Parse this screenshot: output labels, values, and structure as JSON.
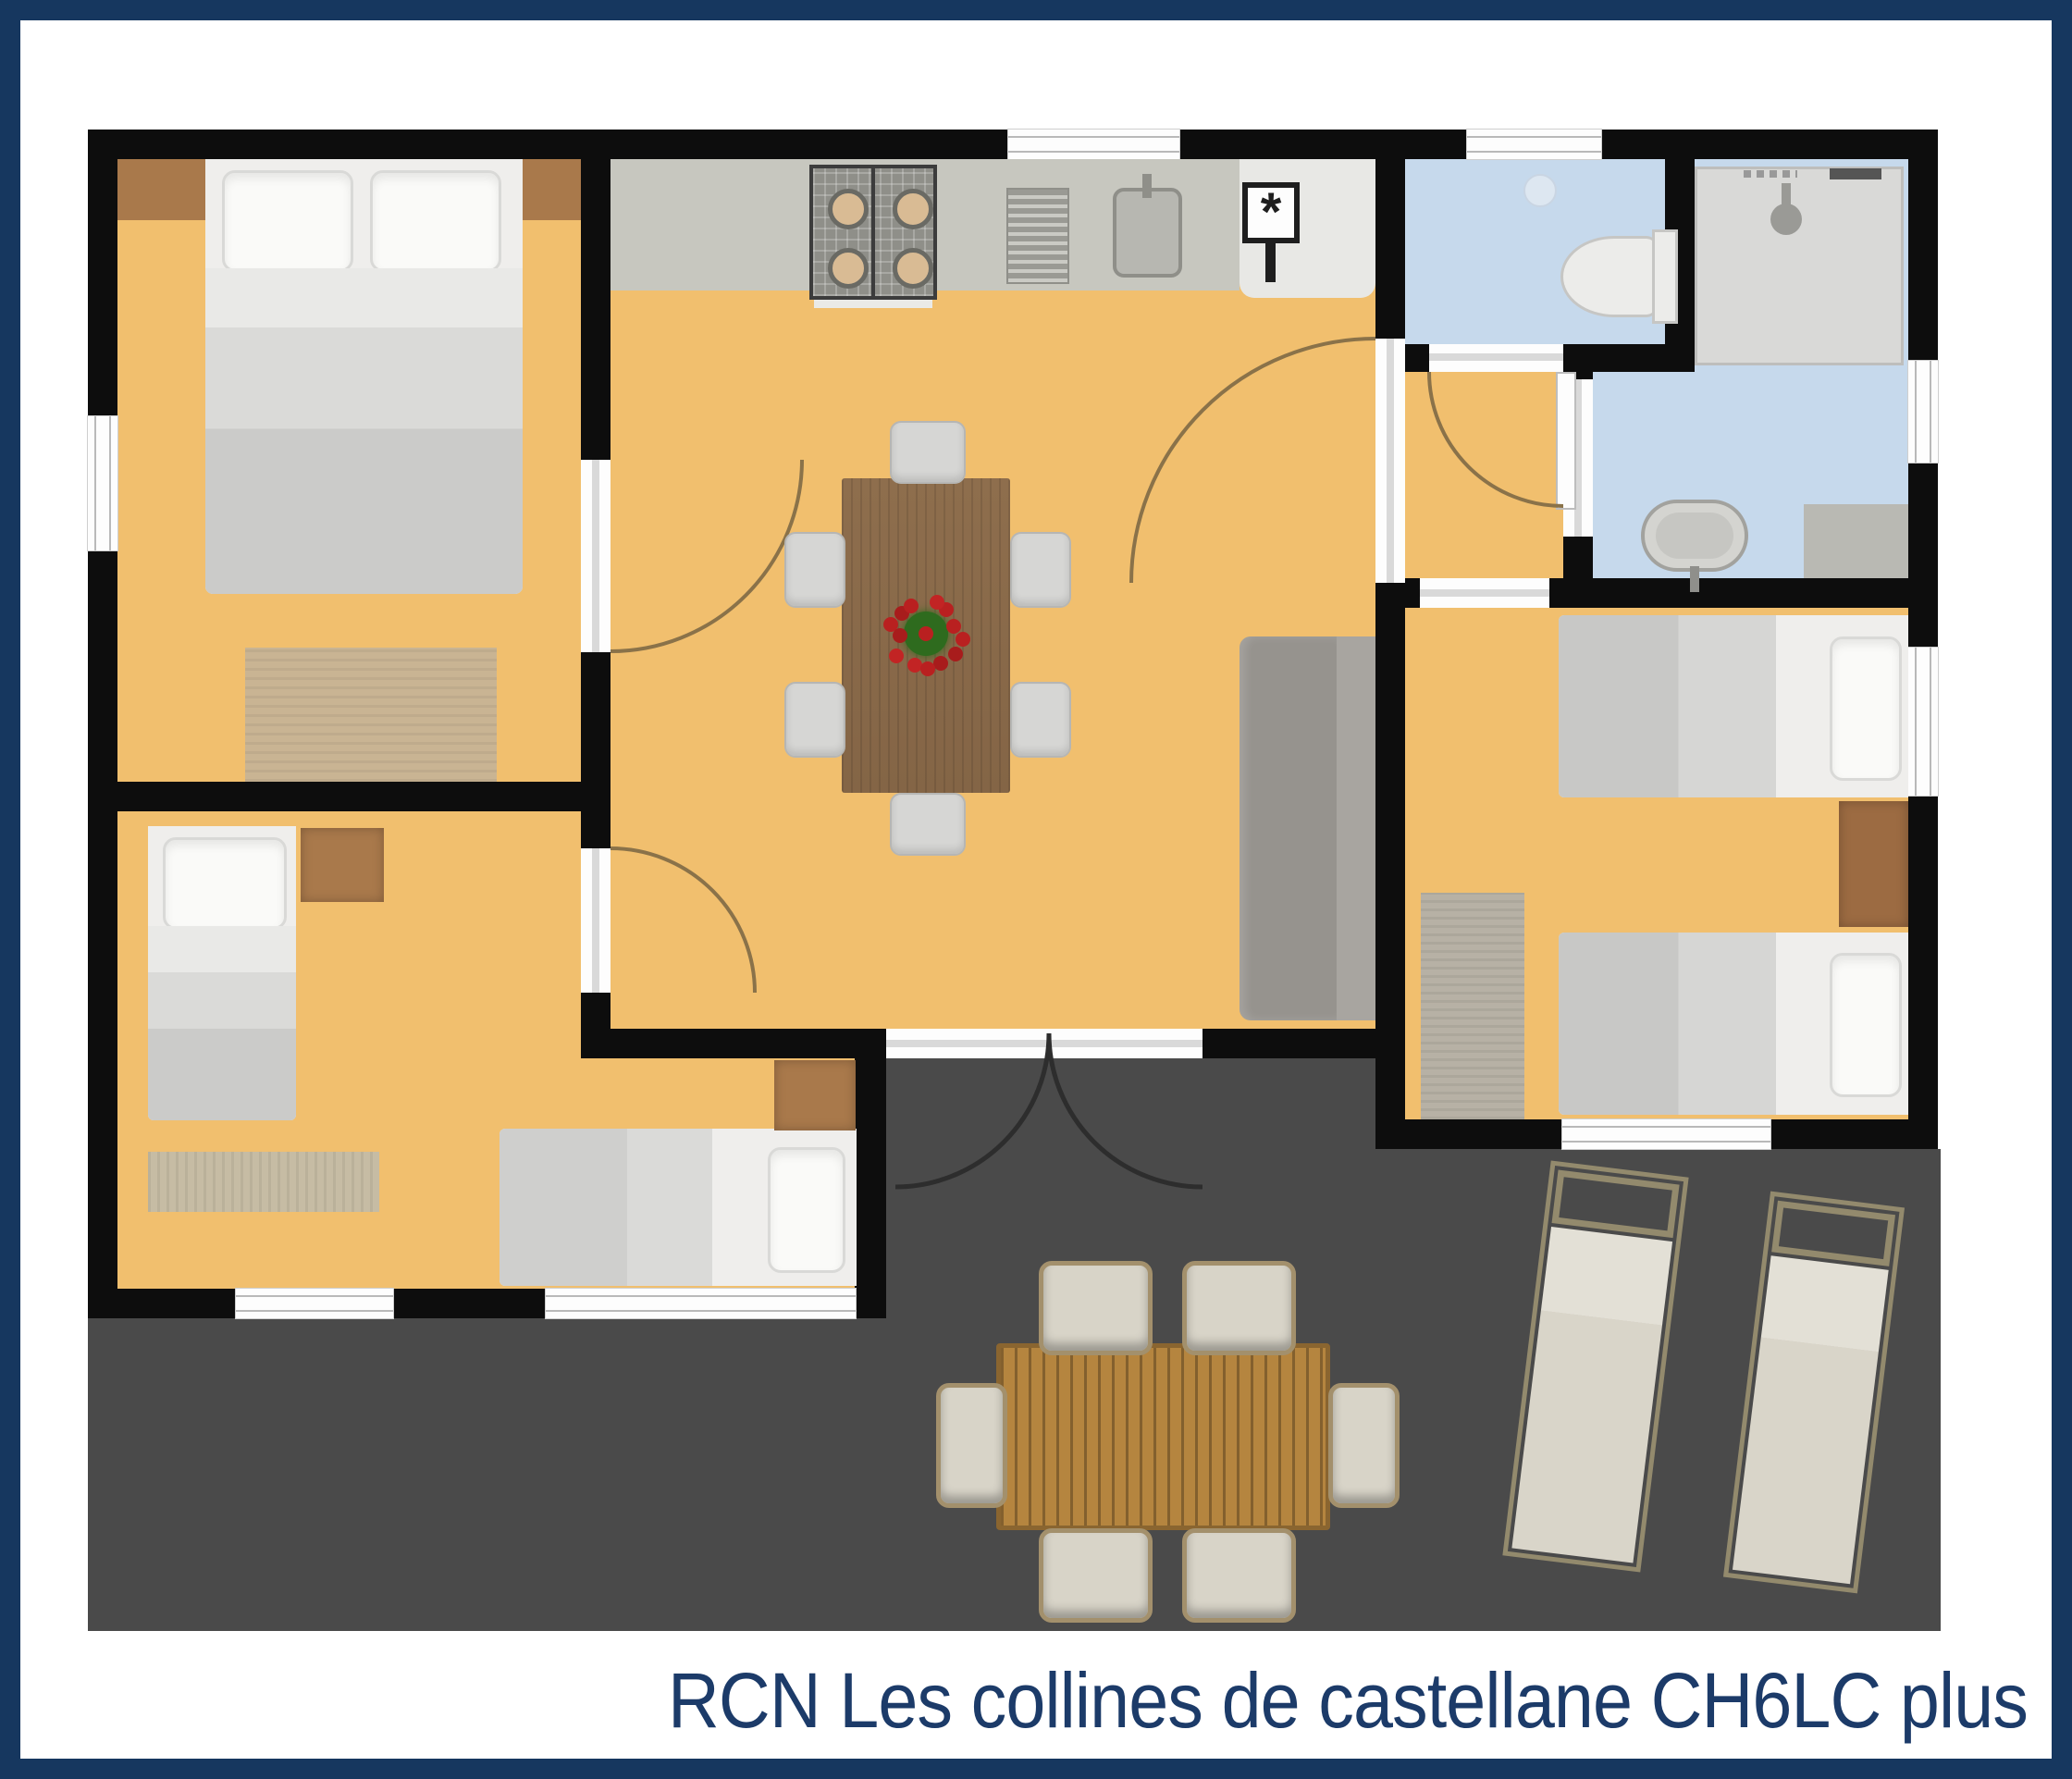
{
  "caption": "RCN Les collines de castellane CH6LC plus",
  "symbols": {
    "boiler": "*"
  },
  "palette": {
    "frame_navy": "#16375f",
    "caption_text": "#1c3b69",
    "wall_black": "#0d0d0d",
    "floor_wood_orange": "#f1bf6e",
    "wet_room_blue": "#c6d9ec",
    "terrace_gray": "#4a4a4a",
    "kitchen_counter_gray": "#c7c7bf",
    "dining_table_wood": "#8b6b4a",
    "outdoor_table_wood": "#b5853f",
    "furniture_brown": "#a9794b",
    "bedding_gray": "#cbcbc9",
    "flower_red": "#b92020",
    "flower_green": "#2e6b1e"
  },
  "rooms": [
    "bedroom-top-left",
    "bedroom-bottom-left",
    "living-dining-kitchen",
    "hallway",
    "wc",
    "shower-room",
    "bathroom",
    "bedroom-right",
    "terrace"
  ],
  "furniture": [
    "double-bed",
    "single-bed-vertical",
    "single-bed-horizontal",
    "single-beds-right-room",
    "nightstands",
    "rugs",
    "kitchen-counter",
    "stove-4-burners",
    "drainboard",
    "sink",
    "boiler-unit",
    "dining-table",
    "six-dining-chairs",
    "flower-centerpiece",
    "sofa",
    "toilet",
    "shower-tray",
    "washbasin",
    "bathroom-counter",
    "outdoor-dining-table",
    "six-outdoor-chairs",
    "two-sun-loungers",
    "door-swing-arcs",
    "windows",
    "french-entrance-doors"
  ]
}
